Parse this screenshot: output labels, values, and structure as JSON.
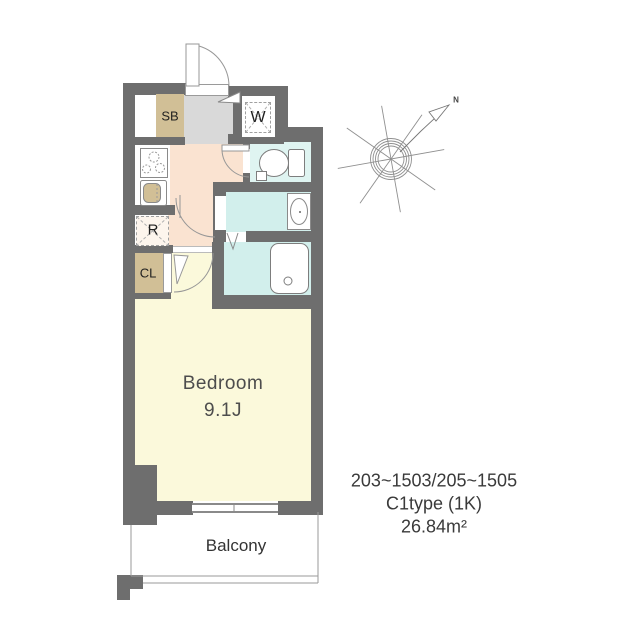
{
  "palette": {
    "wall": "#6e6e6e",
    "genkan_floor": "#d9d9d9",
    "hall_floor": "#fae3d1",
    "toilet_floor": "#dff4f1",
    "bath_floor": "#d2efec",
    "bedroom_floor": "#fbf9db",
    "storage_tan": "#d1bf96"
  },
  "plan": {
    "shoe_box_label": "SB",
    "washer_label": "W",
    "fridge_label": "R",
    "closet_label": "CL",
    "bedroom_label": "Bedroom",
    "bedroom_size": "9.1J",
    "balcony_label": "Balcony",
    "north_label": "N"
  },
  "info": {
    "room_numbers": "203~1503/205~1505",
    "plan_type": "C1type (1K)",
    "area": "26.84m²"
  }
}
